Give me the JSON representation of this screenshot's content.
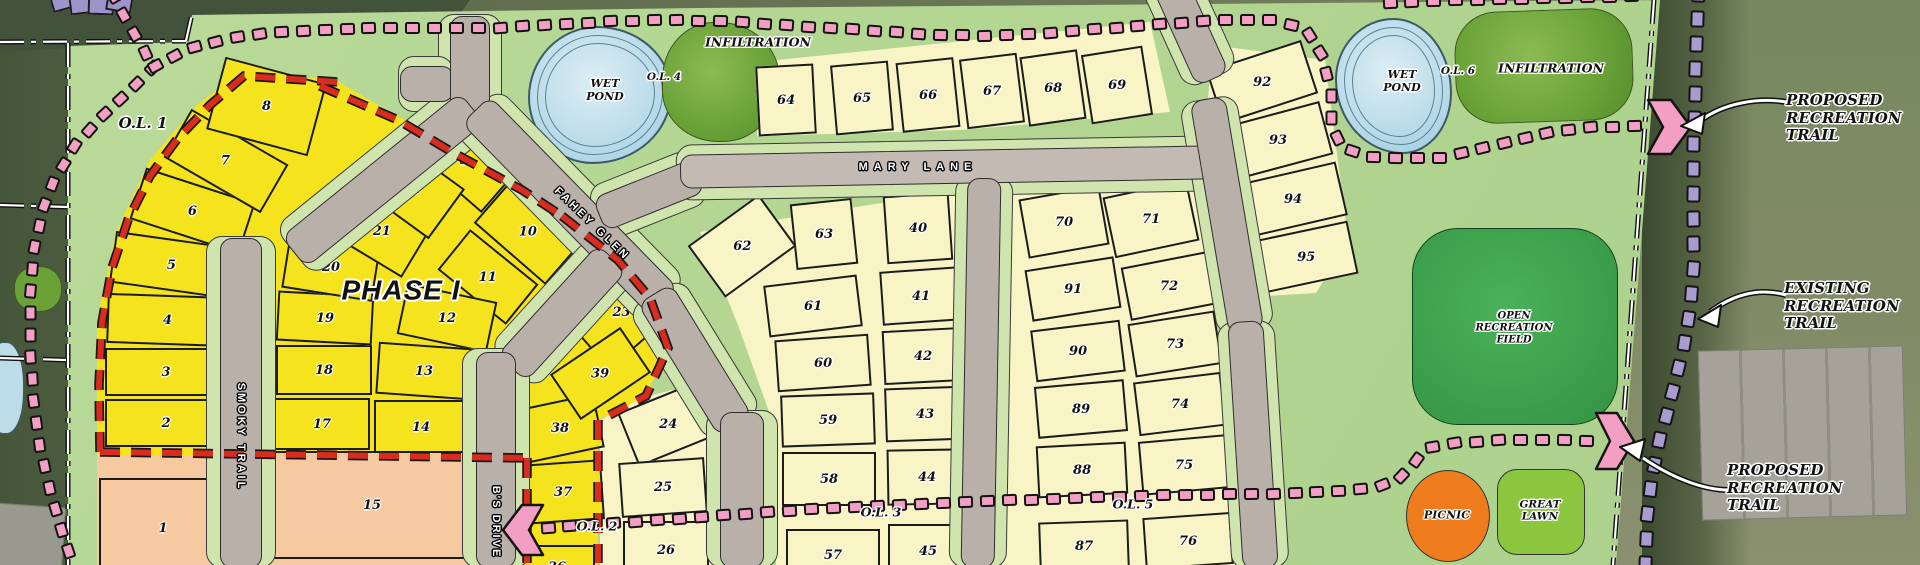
{
  "map": {
    "colors": {
      "plat_green": "#b6d795",
      "phase1_yellow": "#f5e41d",
      "future_cream": "#f8f4c6",
      "outlot_salmon": "#f6c9a1",
      "purple_lot": "#9d94c9",
      "pink_trail": "#f29fc3",
      "purple_trail": "#a89bd0",
      "red_phase_boundary": "#d92b1e",
      "road_gray": "#b9b0aa",
      "verge_green": "#cfe5ad",
      "pond_blue": "#bcdcea",
      "infiltration_green": "#6aa238",
      "open_field_green": "#3da04c",
      "great_lawn_green": "#8cc63f",
      "picnic_orange": "#ee7b1c"
    },
    "labels": {
      "ol1": "O.L. 1",
      "ol2": "O.L. 2",
      "ol3": "O.L. 3",
      "ol4": "O.L. 4",
      "ol5": "O.L. 5",
      "ol6": "O.L. 6",
      "phase1": "PHASE I",
      "wet_pond_1": "WET\nPOND",
      "wet_pond_2": "WET\nPOND",
      "infiltration_1": "INFILTRATION",
      "infiltration_2": "INFILTRATION",
      "open_recreation_field": "OPEN\nRECREATION\nFIELD",
      "picnic": "PICNIC",
      "great_lawn": "GREAT\nLAWN",
      "proposed_recreation_trail_1": "PROPOSED\nRECREATION\nTRAIL",
      "existing_recreation_trail": "EXISTING\nRECREATION\nTRAIL",
      "proposed_recreation_trail_2": "PROPOSED\nRECREATION\nTRAIL"
    },
    "roads": {
      "smoky_trail": "SMOKY TRAIL",
      "fahey_glen": "FAHEY GLEN",
      "mary_lane": "MARY LANE",
      "bs_drive": "B'S DRIVE"
    },
    "lots": [
      {
        "n": "1",
        "x": 163,
        "y": 528,
        "w": 128,
        "h": 100,
        "r": 0,
        "t": "s"
      },
      {
        "n": "2",
        "x": 166,
        "y": 423,
        "w": 122,
        "h": 48,
        "r": 0,
        "t": "y"
      },
      {
        "n": "3",
        "x": 166,
        "y": 372,
        "w": 122,
        "h": 48,
        "r": 0,
        "t": "y"
      },
      {
        "n": "4",
        "x": 168,
        "y": 320,
        "w": 122,
        "h": 50,
        "r": 2,
        "t": "y"
      },
      {
        "n": "5",
        "x": 172,
        "y": 265,
        "w": 120,
        "h": 52,
        "r": 8,
        "t": "y"
      },
      {
        "n": "6",
        "x": 192,
        "y": 211,
        "w": 115,
        "h": 54,
        "r": 18,
        "t": "y"
      },
      {
        "n": "7",
        "x": 226,
        "y": 161,
        "w": 112,
        "h": 56,
        "r": 30,
        "t": "y"
      },
      {
        "n": "8",
        "x": 266,
        "y": 106,
        "w": 105,
        "h": 75,
        "r": 15,
        "t": "y"
      },
      {
        "n": "9",
        "x": 464,
        "y": 160,
        "w": 95,
        "h": 58,
        "r": 41,
        "t": "y"
      },
      {
        "n": "10",
        "x": 528,
        "y": 232,
        "w": 95,
        "h": 58,
        "r": 41,
        "t": "y"
      },
      {
        "n": "11",
        "x": 488,
        "y": 277,
        "w": 88,
        "h": 52,
        "r": 39,
        "t": "y"
      },
      {
        "n": "12",
        "x": 447,
        "y": 318,
        "w": 92,
        "h": 52,
        "r": 12,
        "t": "y"
      },
      {
        "n": "13",
        "x": 424,
        "y": 371,
        "w": 94,
        "h": 52,
        "r": 4,
        "t": "y"
      },
      {
        "n": "14",
        "x": 421,
        "y": 427,
        "w": 94,
        "h": 54,
        "r": 0,
        "t": "y"
      },
      {
        "n": "15",
        "x": 372,
        "y": 505,
        "w": 235,
        "h": 108,
        "r": 0,
        "t": "s"
      },
      {
        "n": "17",
        "x": 322,
        "y": 424,
        "w": 96,
        "h": 52,
        "r": 0,
        "t": "y"
      },
      {
        "n": "18",
        "x": 324,
        "y": 370,
        "w": 96,
        "h": 50,
        "r": 0,
        "t": "y"
      },
      {
        "n": "19",
        "x": 325,
        "y": 318,
        "w": 96,
        "h": 50,
        "r": 3,
        "t": "y"
      },
      {
        "n": "20",
        "x": 331,
        "y": 267,
        "w": 92,
        "h": 55,
        "r": 9,
        "t": "y"
      },
      {
        "n": "21",
        "x": 382,
        "y": 231,
        "w": 82,
        "h": 60,
        "r": 31,
        "t": "y"
      },
      {
        "n": "22",
        "x": 412,
        "y": 189,
        "w": 86,
        "h": 62,
        "r": 36,
        "t": "y"
      },
      {
        "n": "23",
        "x": 621,
        "y": 312,
        "w": 95,
        "h": 72,
        "r": -41,
        "t": "y"
      },
      {
        "n": "24",
        "x": 668,
        "y": 424,
        "w": 86,
        "h": 58,
        "r": -22,
        "t": "c"
      },
      {
        "n": "25",
        "x": 663,
        "y": 487,
        "w": 86,
        "h": 55,
        "r": -4,
        "t": "c"
      },
      {
        "n": "26",
        "x": 666,
        "y": 550,
        "w": 86,
        "h": 58,
        "r": 0,
        "t": "c"
      },
      {
        "n": "36",
        "x": 557,
        "y": 567,
        "w": 76,
        "h": 44,
        "r": 0,
        "t": "y"
      },
      {
        "n": "37",
        "x": 563,
        "y": 492,
        "w": 80,
        "h": 60,
        "r": -4,
        "t": "y"
      },
      {
        "n": "38",
        "x": 560,
        "y": 428,
        "w": 80,
        "h": 55,
        "r": -12,
        "t": "y"
      },
      {
        "n": "39",
        "x": 600,
        "y": 373,
        "w": 85,
        "h": 55,
        "r": -34,
        "t": "y"
      },
      {
        "n": "40",
        "x": 918,
        "y": 228,
        "w": 66,
        "h": 68,
        "r": -4,
        "t": "c"
      },
      {
        "n": "41",
        "x": 921,
        "y": 296,
        "w": 80,
        "h": 54,
        "r": -4,
        "t": "c"
      },
      {
        "n": "42",
        "x": 923,
        "y": 356,
        "w": 80,
        "h": 54,
        "r": -3,
        "t": "c"
      },
      {
        "n": "43",
        "x": 925,
        "y": 414,
        "w": 80,
        "h": 54,
        "r": -2,
        "t": "c"
      },
      {
        "n": "44",
        "x": 927,
        "y": 477,
        "w": 80,
        "h": 56,
        "r": -1,
        "t": "c"
      },
      {
        "n": "45",
        "x": 928,
        "y": 551,
        "w": 80,
        "h": 54,
        "r": 0,
        "t": "c"
      },
      {
        "n": "57",
        "x": 833,
        "y": 555,
        "w": 94,
        "h": 52,
        "r": 0,
        "t": "c"
      },
      {
        "n": "58",
        "x": 829,
        "y": 479,
        "w": 94,
        "h": 54,
        "r": 0,
        "t": "c"
      },
      {
        "n": "59",
        "x": 828,
        "y": 420,
        "w": 94,
        "h": 52,
        "r": -2,
        "t": "c"
      },
      {
        "n": "60",
        "x": 823,
        "y": 363,
        "w": 94,
        "h": 52,
        "r": -4,
        "t": "c"
      },
      {
        "n": "61",
        "x": 813,
        "y": 306,
        "w": 94,
        "h": 52,
        "r": -7,
        "t": "c"
      },
      {
        "n": "62",
        "x": 742,
        "y": 246,
        "w": 88,
        "h": 64,
        "r": -36,
        "t": "c"
      },
      {
        "n": "63",
        "x": 824,
        "y": 234,
        "w": 62,
        "h": 66,
        "r": -6,
        "t": "c"
      },
      {
        "n": "64",
        "x": 786,
        "y": 100,
        "w": 58,
        "h": 70,
        "r": -3,
        "t": "c"
      },
      {
        "n": "65",
        "x": 862,
        "y": 98,
        "w": 58,
        "h": 70,
        "r": -5,
        "t": "c"
      },
      {
        "n": "66",
        "x": 928,
        "y": 95,
        "w": 58,
        "h": 70,
        "r": -6,
        "t": "c"
      },
      {
        "n": "67",
        "x": 992,
        "y": 91,
        "w": 58,
        "h": 70,
        "r": -7,
        "t": "c"
      },
      {
        "n": "68",
        "x": 1053,
        "y": 88,
        "w": 58,
        "h": 70,
        "r": -8,
        "t": "c"
      },
      {
        "n": "69",
        "x": 1117,
        "y": 85,
        "w": 62,
        "h": 70,
        "r": -9,
        "t": "c"
      },
      {
        "n": "70",
        "x": 1064,
        "y": 222,
        "w": 82,
        "h": 60,
        "r": -10,
        "t": "c"
      },
      {
        "n": "71",
        "x": 1151,
        "y": 219,
        "w": 86,
        "h": 62,
        "r": -12,
        "t": "c"
      },
      {
        "n": "72",
        "x": 1169,
        "y": 286,
        "w": 88,
        "h": 54,
        "r": -11,
        "t": "c"
      },
      {
        "n": "73",
        "x": 1175,
        "y": 344,
        "w": 88,
        "h": 54,
        "r": -9,
        "t": "c"
      },
      {
        "n": "74",
        "x": 1180,
        "y": 404,
        "w": 88,
        "h": 54,
        "r": -7,
        "t": "c"
      },
      {
        "n": "75",
        "x": 1184,
        "y": 465,
        "w": 88,
        "h": 54,
        "r": -5,
        "t": "c"
      },
      {
        "n": "76",
        "x": 1188,
        "y": 541,
        "w": 88,
        "h": 52,
        "r": -4,
        "t": "c"
      },
      {
        "n": "87",
        "x": 1084,
        "y": 546,
        "w": 90,
        "h": 50,
        "r": -2,
        "t": "c"
      },
      {
        "n": "88",
        "x": 1082,
        "y": 470,
        "w": 90,
        "h": 52,
        "r": -3,
        "t": "c"
      },
      {
        "n": "89",
        "x": 1081,
        "y": 409,
        "w": 90,
        "h": 52,
        "r": -5,
        "t": "c"
      },
      {
        "n": "90",
        "x": 1078,
        "y": 351,
        "w": 90,
        "h": 52,
        "r": -7,
        "t": "c"
      },
      {
        "n": "91",
        "x": 1073,
        "y": 289,
        "w": 90,
        "h": 52,
        "r": -9,
        "t": "c"
      },
      {
        "n": "92",
        "x": 1262,
        "y": 82,
        "w": 100,
        "h": 56,
        "r": -18,
        "t": "c"
      },
      {
        "n": "93",
        "x": 1278,
        "y": 140,
        "w": 100,
        "h": 55,
        "r": -15,
        "t": "c"
      },
      {
        "n": "94",
        "x": 1293,
        "y": 199,
        "w": 100,
        "h": 55,
        "r": -13,
        "t": "c"
      },
      {
        "n": "95",
        "x": 1306,
        "y": 257,
        "w": 96,
        "h": 54,
        "r": -12,
        "t": "c"
      }
    ]
  }
}
